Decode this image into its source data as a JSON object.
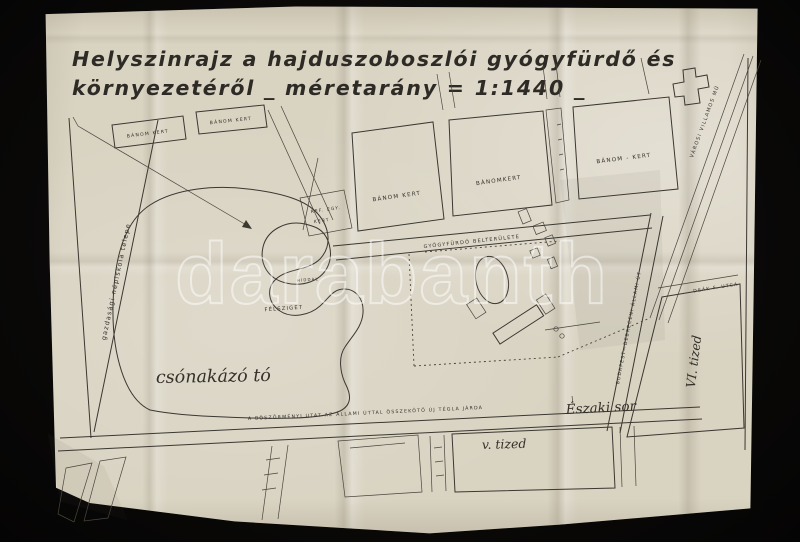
{
  "title": {
    "line1": "Helyszinrajz a hajduszoboszlói gyógyfürdő és",
    "line2": "környezetéről _ méretarány = 1:1440 _",
    "scale": "1:1440"
  },
  "watermark": {
    "text": "darabanth"
  },
  "labels": {
    "banom_small_1": "BÁNOM KERT",
    "banom_small_2": "BÁNOM KERT",
    "banom_a": "BÁNOM KERT",
    "banom_b": "BÁNOMKERT",
    "banom_c": "BÁNOM - KERT",
    "ref_kert_line1": "REF. EGY.",
    "ref_kert_line2": "KERT",
    "gyogyfurdo": "GYÓGYFÜRDŐ BELTERÜLETE",
    "hiddal": "HÍDDAL",
    "felsziget": "FÉLSZIGET",
    "csonakazo_to": "csónakázó tó",
    "nepiskola": "gazdasági népiskola telepe",
    "jarda": "A BÖSZÖRMÉNYI UTAT AZ ÁLLAMI ÚTTAL ÖSSZEKÖTŐ ÚJ TÉGLA JÁRDA",
    "eszaki_sor": "Északi sor",
    "v_tized": "v. tized",
    "vi_tized": "VI. tized",
    "deak_utca": "DEÁK F. UTCA",
    "allami_ut": "BUDAPEST—DEBRECENI ÁLLAMI ÚT",
    "villamos": "VÁROSI VILLAMOS MŰ"
  },
  "colors": {
    "backdrop": "#0a0908",
    "paper": "#d9d3c2",
    "ink": "#3b3731",
    "watermark": "#ffffff"
  }
}
